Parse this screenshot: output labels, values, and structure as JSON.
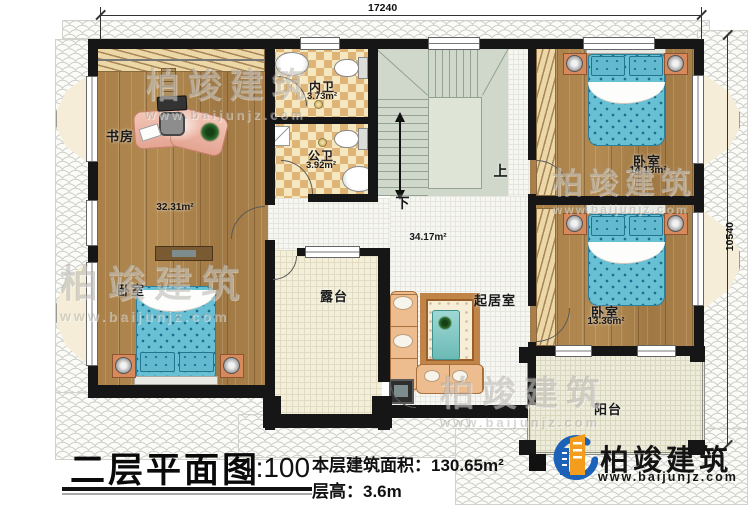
{
  "dimensions": {
    "top_width": "17240",
    "right_height": "10540"
  },
  "stairs": {
    "up": "上",
    "down": "下"
  },
  "rooms": {
    "study": {
      "label": "书房"
    },
    "suite_area": "32.31m²",
    "bedroom_left": {
      "label": "卧室"
    },
    "inner_bath": {
      "label": "内卫",
      "area": "3.73m²"
    },
    "public_bath": {
      "label": "公卫",
      "area": "3.92m²"
    },
    "hall": {
      "area": "34.17m²"
    },
    "bedroom_top_right": {
      "label": "卧室",
      "area": "14.13m²"
    },
    "bedroom_mid_right": {
      "label": "卧室",
      "area": "13.36m²"
    },
    "terrace": {
      "label": "露台"
    },
    "living_room": {
      "label": "起居室"
    },
    "balcony": {
      "label": "阳台"
    }
  },
  "title_block": {
    "floor_title": "二层平面图",
    "scale": "1:100",
    "floor_area": "本层建筑面积：130.65m²",
    "floor_height": "层高：3.6m"
  },
  "branding": {
    "company": "柏竣建筑",
    "website": "www.baijunjz.com"
  },
  "watermark": {
    "company": "柏竣建筑",
    "website": "www.baijunjz.com"
  },
  "colors": {
    "wall": "#161616",
    "wood_floor": "#a8814b",
    "bed_blue": "#68c0d5",
    "stair_green": "#cfd8ca",
    "logo_blue": "#1b62b8",
    "logo_orange": "#f49c1c"
  }
}
